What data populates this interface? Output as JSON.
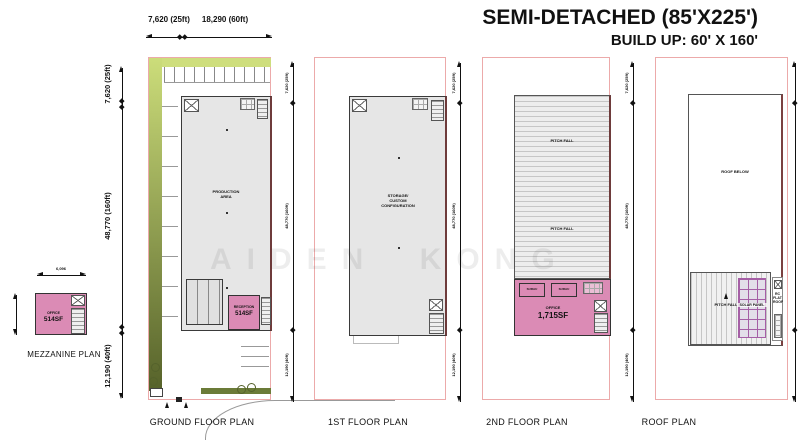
{
  "header": {
    "title": "SEMI-DETACHED (85'X225')",
    "subtitle": "BUILD UP: 60' X 160'"
  },
  "dims": {
    "top_left": "7,620 (25ft)",
    "top_right": "18,290 (60ft)",
    "v_top": "7,620 (25ft)",
    "v_mid": "48,770 (160ft)",
    "v_bot": "12,190 (40ft)",
    "mezz_width": "6,096"
  },
  "plans": {
    "mezzanine": {
      "title": "MEZZANINE PLAN",
      "office": "OFFICE",
      "office_area": "514SF"
    },
    "ground": {
      "title": "GROUND FLOOR PLAN",
      "hall": "PRODUCTION\nAREA",
      "reception": "RECEPTION",
      "reception_area": "514SF"
    },
    "first": {
      "title": "1ST FLOOR PLAN",
      "hall": "STORAGE/\nCUSTOM\nCONFIGURATION"
    },
    "second": {
      "title": "2ND FLOOR PLAN",
      "pitch": "PITCH FALL",
      "room_a": "SURAU",
      "room_b": "SURAU",
      "office": "OFFICE",
      "office_area": "1,715SF"
    },
    "roof": {
      "title": "ROOF PLAN",
      "roof_below": "ROOF BELOW",
      "pitch": "PITCH FALL",
      "solar": "SOLAR PANEL",
      "flat_roof": "RC\nFLAT\nROOF"
    }
  },
  "watermark": "AIDEN KONG",
  "colors": {
    "room_pink": "#DB8BB5",
    "boundary_red": "#ECAAAA",
    "hall_grey": "#E6E6E6",
    "green_light": "#CCDD7A",
    "green_dark": "#56622A",
    "party_wall": "#6E3B3B",
    "solar_purple": "#A55FA5"
  }
}
